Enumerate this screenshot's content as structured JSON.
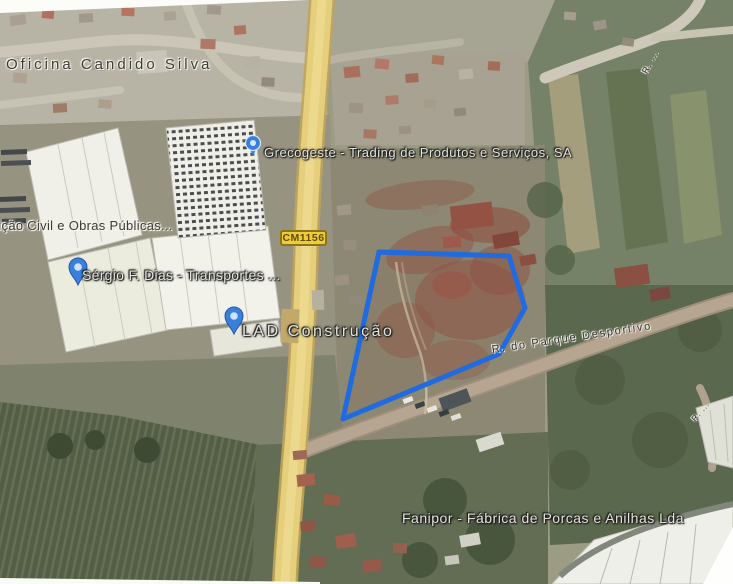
{
  "map": {
    "road_badge": "CM1156",
    "labels": {
      "oficina": "Oficina Candido Silva",
      "grecogeste": "Grecogeste - Trading de Produtos e Serviços, SA",
      "construcao_civil": "ução Civil e Obras Públicas...",
      "sergio": "Sérgio F. Dias - Transportes ...",
      "lad": "LAD Construção",
      "parque_desportivo": "R. do Parque Desportivo",
      "fanipor": "Fanipor - Fábrica de Porcas e Anilhas Lda",
      "street_top_right": "R. ...",
      "street_right_edge": "R. ..."
    },
    "colors": {
      "parcel_outline": "#1565e0",
      "road_yellow": "#e5cd78",
      "badge_bg": "#efcb3a",
      "badge_border": "#8a7614",
      "badge_text": "#5f4e08",
      "pin": "#2f7bdd"
    },
    "parcel": {
      "outline_points": "379,252 509,256 525,308 499,354 343,419"
    }
  }
}
